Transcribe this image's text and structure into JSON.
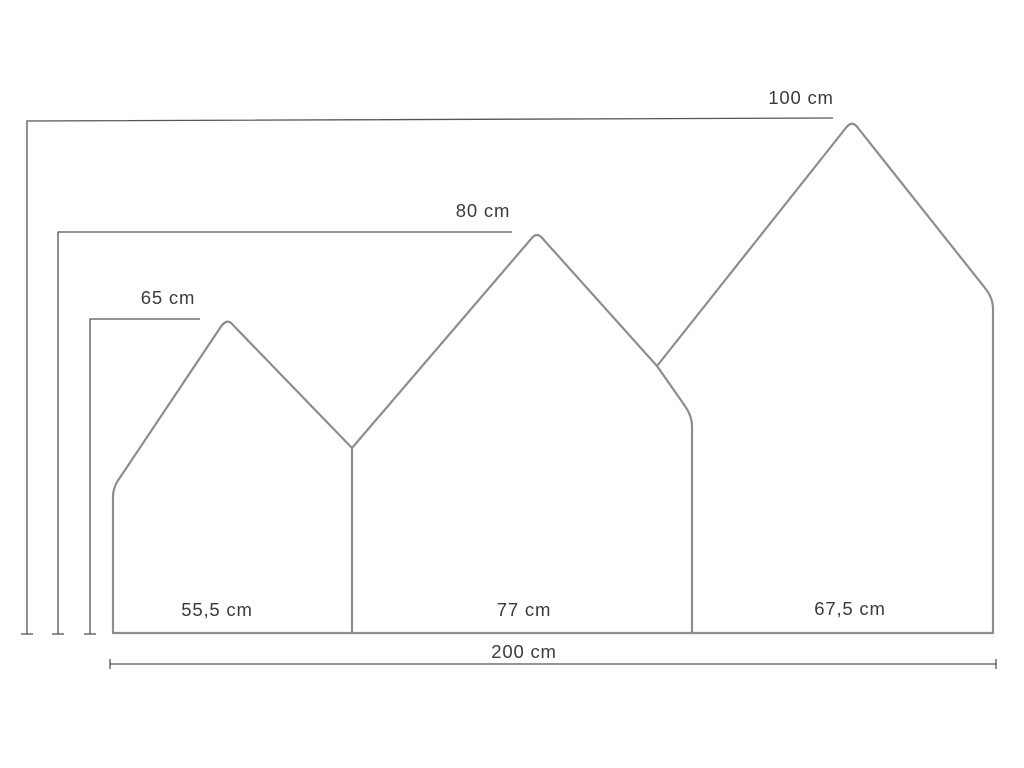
{
  "diagram": {
    "type": "dimension-drawing",
    "subject": "three-house panel headboard",
    "unit": "cm",
    "labels": {
      "height_tall": "100 cm",
      "height_mid": "80 cm",
      "height_small": "65 cm",
      "width_left": "55,5 cm",
      "width_mid": "77 cm",
      "width_right": "67,5 cm",
      "width_total": "200 cm"
    },
    "measurements": {
      "house_left": {
        "height_cm": 65,
        "width_cm": 55.5
      },
      "house_middle": {
        "height_cm": 80,
        "width_cm": 77
      },
      "house_right": {
        "height_cm": 100,
        "width_cm": 67.5
      },
      "total_width_cm": 200
    },
    "colors": {
      "outline": "#8d8d8d",
      "dimension_line": "#555555",
      "text": "#3b3b3b",
      "background": "#ffffff"
    }
  }
}
